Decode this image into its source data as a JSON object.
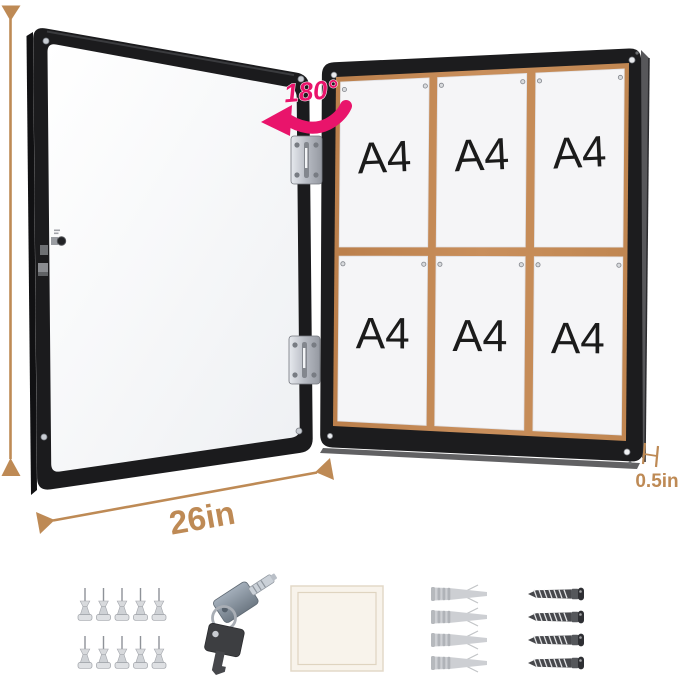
{
  "annotations": {
    "height_label": "28in",
    "width_label": "26in",
    "depth_label": "0.5in",
    "rotation_label": "180°",
    "dimension_color": "#BE8A55",
    "rotation_color": "#E9146B"
  },
  "door": {
    "frame_color": "#1B1B1D",
    "panel_color": "#F4F5F7",
    "hinge_count": 2
  },
  "board": {
    "frame_color": "#1C1C1E",
    "cork_color": "#C48753",
    "paper_color": "#F5F5F7",
    "rows": 2,
    "columns": 3,
    "papers": [
      {
        "label": "A4"
      },
      {
        "label": "A4"
      },
      {
        "label": "A4"
      },
      {
        "label": "A4"
      },
      {
        "label": "A4"
      },
      {
        "label": "A4"
      }
    ]
  },
  "accessories": {
    "pushpins": {
      "icon": "pushpin-icon",
      "count": 10
    },
    "keys": {
      "icon": "keys-icon",
      "count": 2
    },
    "note_pad": {
      "icon": "note-pad-icon",
      "count": 1
    },
    "wall_anchors": {
      "icon": "wall-anchor-icon",
      "count": 4
    },
    "screws": {
      "icon": "screw-icon",
      "count": 4
    }
  }
}
